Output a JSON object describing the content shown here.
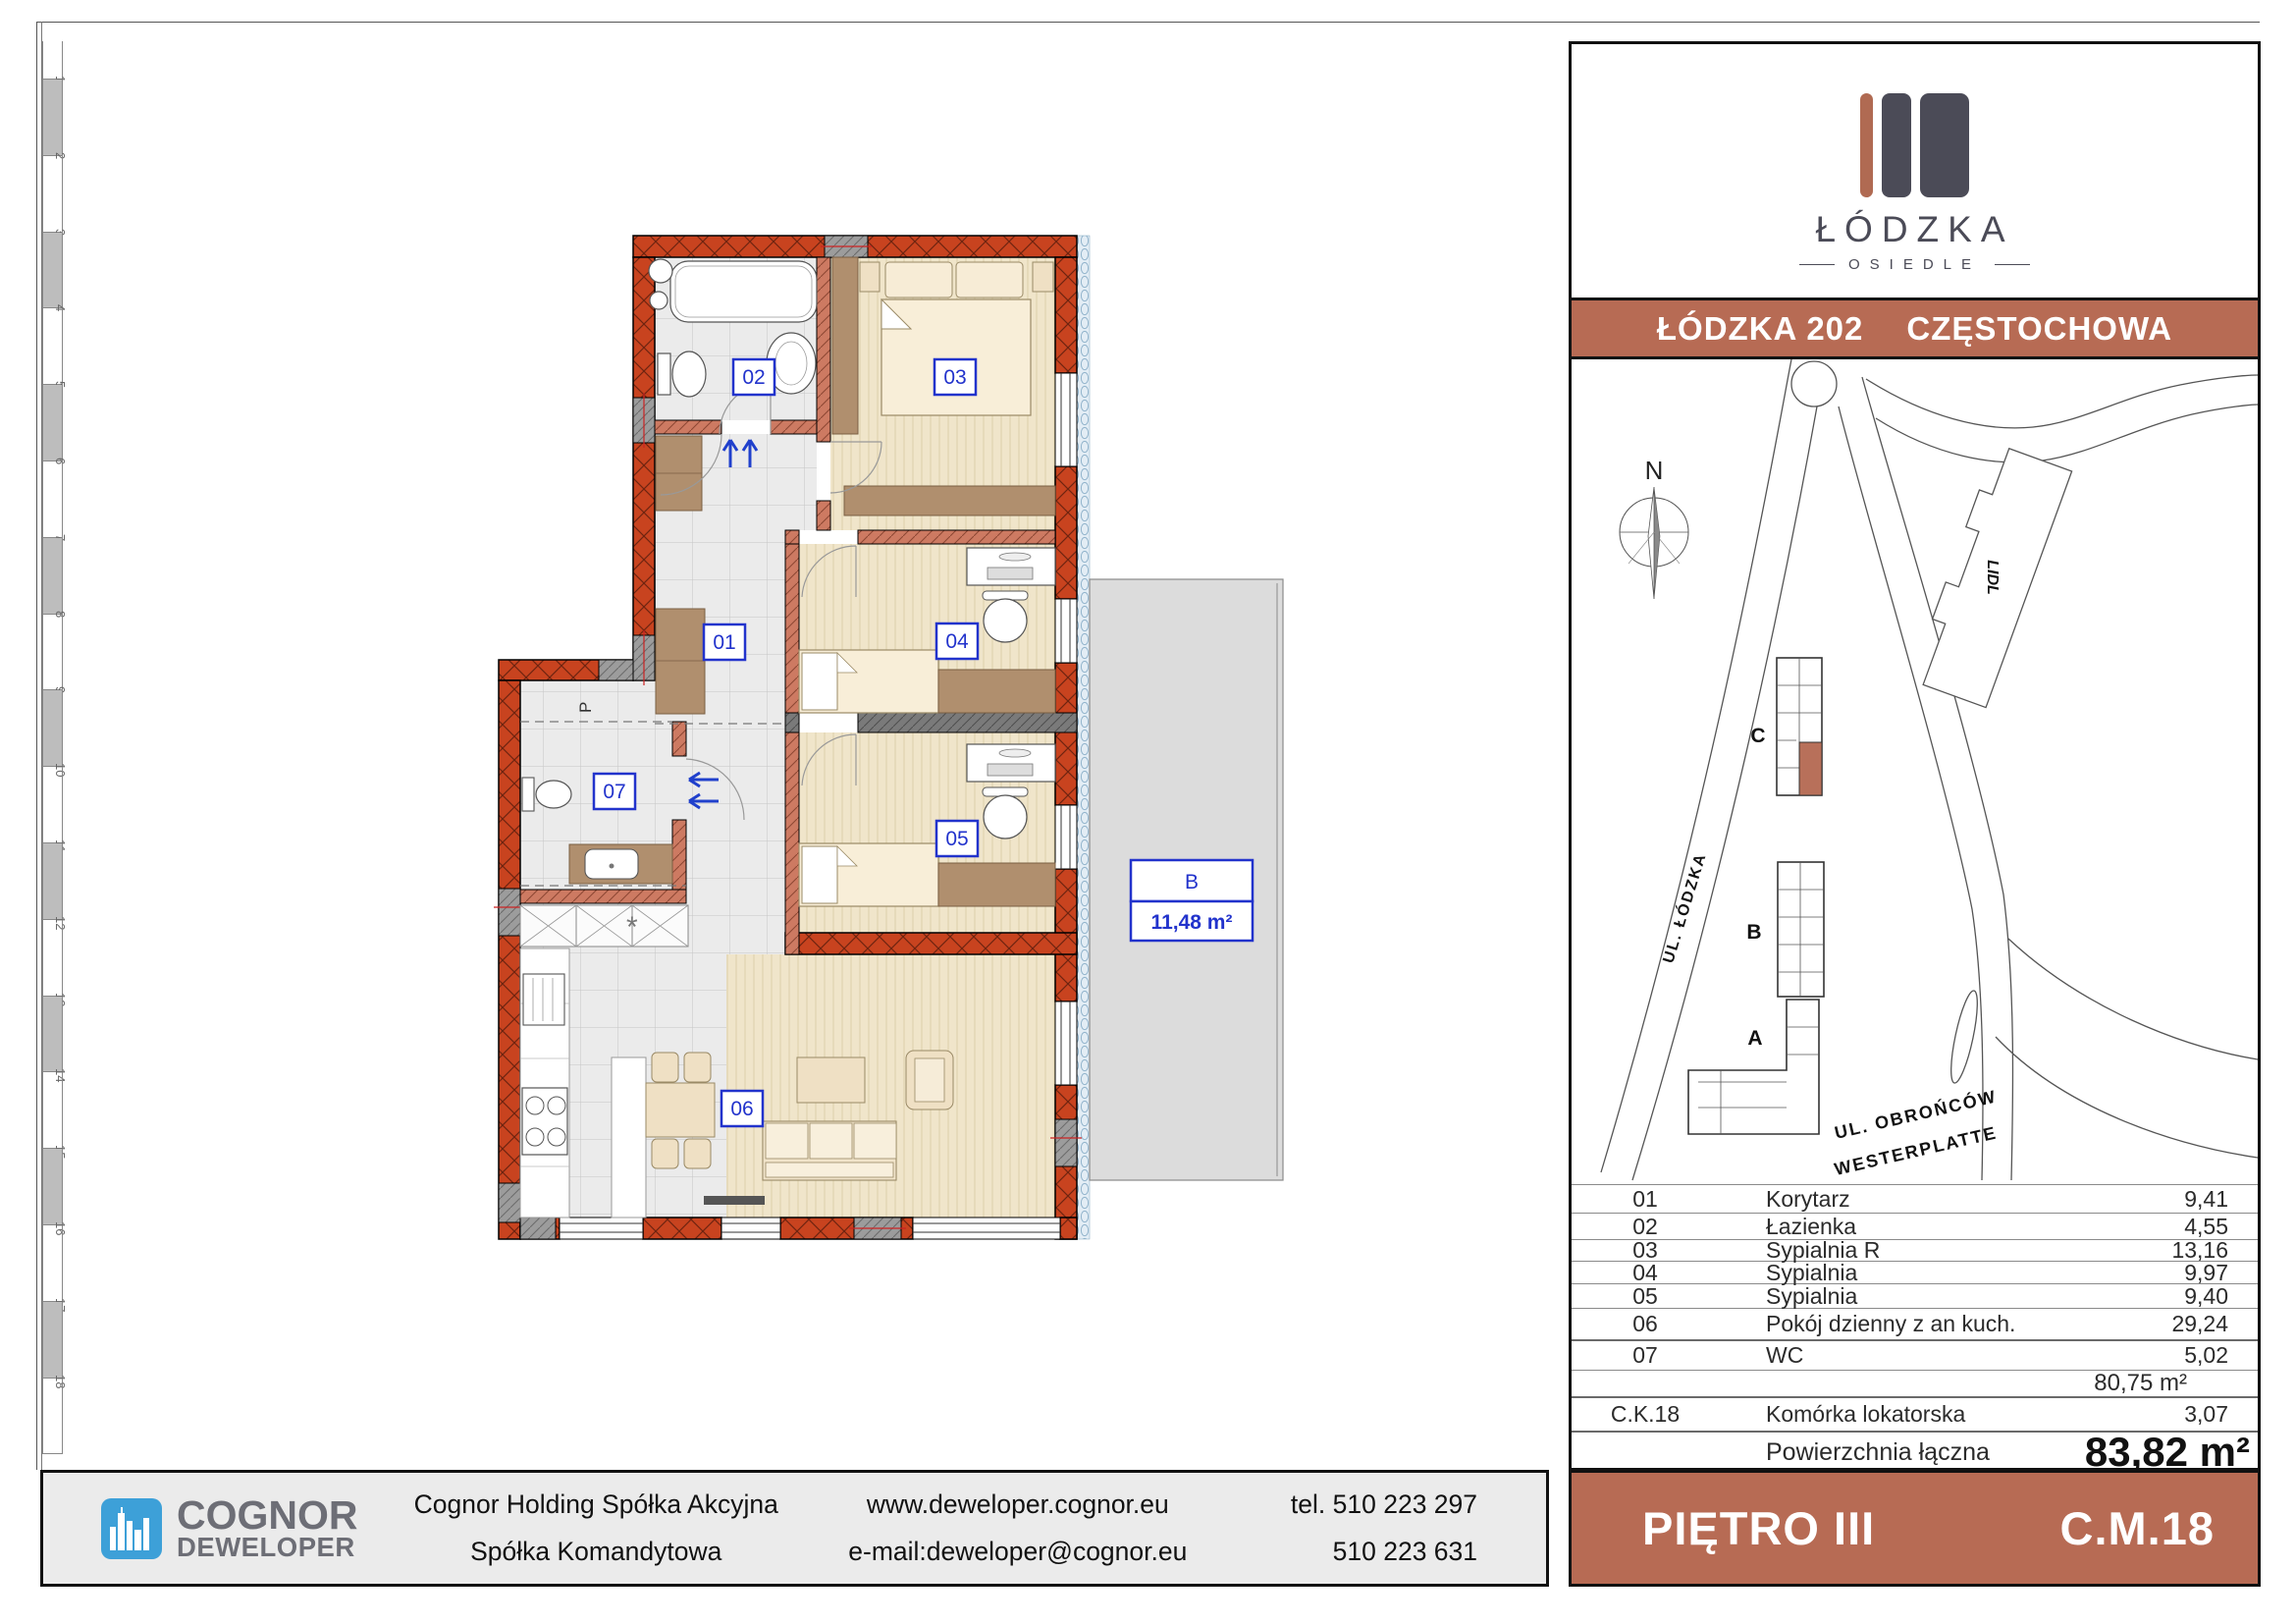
{
  "ruler": {
    "numbers": [
      "1",
      "2",
      "3",
      "4",
      "5",
      "6",
      "7",
      "8",
      "9",
      "10",
      "11",
      "12",
      "13",
      "14",
      "15",
      "16",
      "17",
      "18"
    ]
  },
  "floor_plan": {
    "rooms": [
      {
        "id": "01"
      },
      {
        "id": "02"
      },
      {
        "id": "03"
      },
      {
        "id": "04"
      },
      {
        "id": "05"
      },
      {
        "id": "06"
      },
      {
        "id": "07"
      }
    ],
    "balcony": {
      "letter": "B",
      "area": "11,48 m²"
    },
    "washer_label": "P",
    "vent_symbol": "*"
  },
  "brand": {
    "name": "ŁÓDZKA",
    "subtitle": "OSIEDLE"
  },
  "title_bar": {
    "project": "ŁÓDZKA 202",
    "city": "CZĘSTOCHOWA"
  },
  "site_map": {
    "north_label": "N",
    "store_label": "LIDL",
    "buildings": [
      {
        "label": "C"
      },
      {
        "label": "B"
      },
      {
        "label": "A"
      }
    ],
    "street_lodzka": "UL. ŁÓDZKA",
    "street_obroncow_1": "UL. OBROŃCÓW",
    "street_obroncow_2": "WESTERPLATTE"
  },
  "rooms_table": {
    "rows": [
      {
        "no": "01",
        "name": "Korytarz",
        "area": "9,41"
      },
      {
        "no": "02",
        "name": "Łazienka",
        "area": "4,55"
      },
      {
        "no": "03",
        "name": "Sypialnia R",
        "area": "13,16"
      },
      {
        "no": "04",
        "name": "Sypialnia",
        "area": "9,97"
      },
      {
        "no": "05",
        "name": "Sypialnia",
        "area": "9,40"
      },
      {
        "no": "06",
        "name": "Pokój dzienny z an kuch.",
        "area": "29,24"
      },
      {
        "no": "07",
        "name": "WC",
        "area": "5,02"
      }
    ],
    "subtotal": "80,75 m²",
    "extra_row": {
      "no": "C.K.18",
      "name": "Komórka lokatorska",
      "area": "3,07"
    },
    "total_label": "Powierzchnia łączna",
    "total_value": "83,82 m²"
  },
  "footer": {
    "logo_top": "COGNOR",
    "logo_bottom": "DEWELOPER",
    "company_line1": "Cognor Holding Spółka Akcyjna",
    "company_line2": "Spółka Komandytowa",
    "web": "www.deweloper.cognor.eu",
    "email": "e-mail:deweloper@cognor.eu",
    "phone1": "tel. 510 223 297",
    "phone2": "510 223 631"
  },
  "floor_plate": {
    "floor": "PIĘTRO III",
    "unit": "C.M.18"
  },
  "colors": {
    "terracotta": "#b76b54",
    "dark_slate": "#4b4b57",
    "wall_red": "#c8431f",
    "cognor_blue": "#3da0d8",
    "label_blue": "#2233cc"
  }
}
